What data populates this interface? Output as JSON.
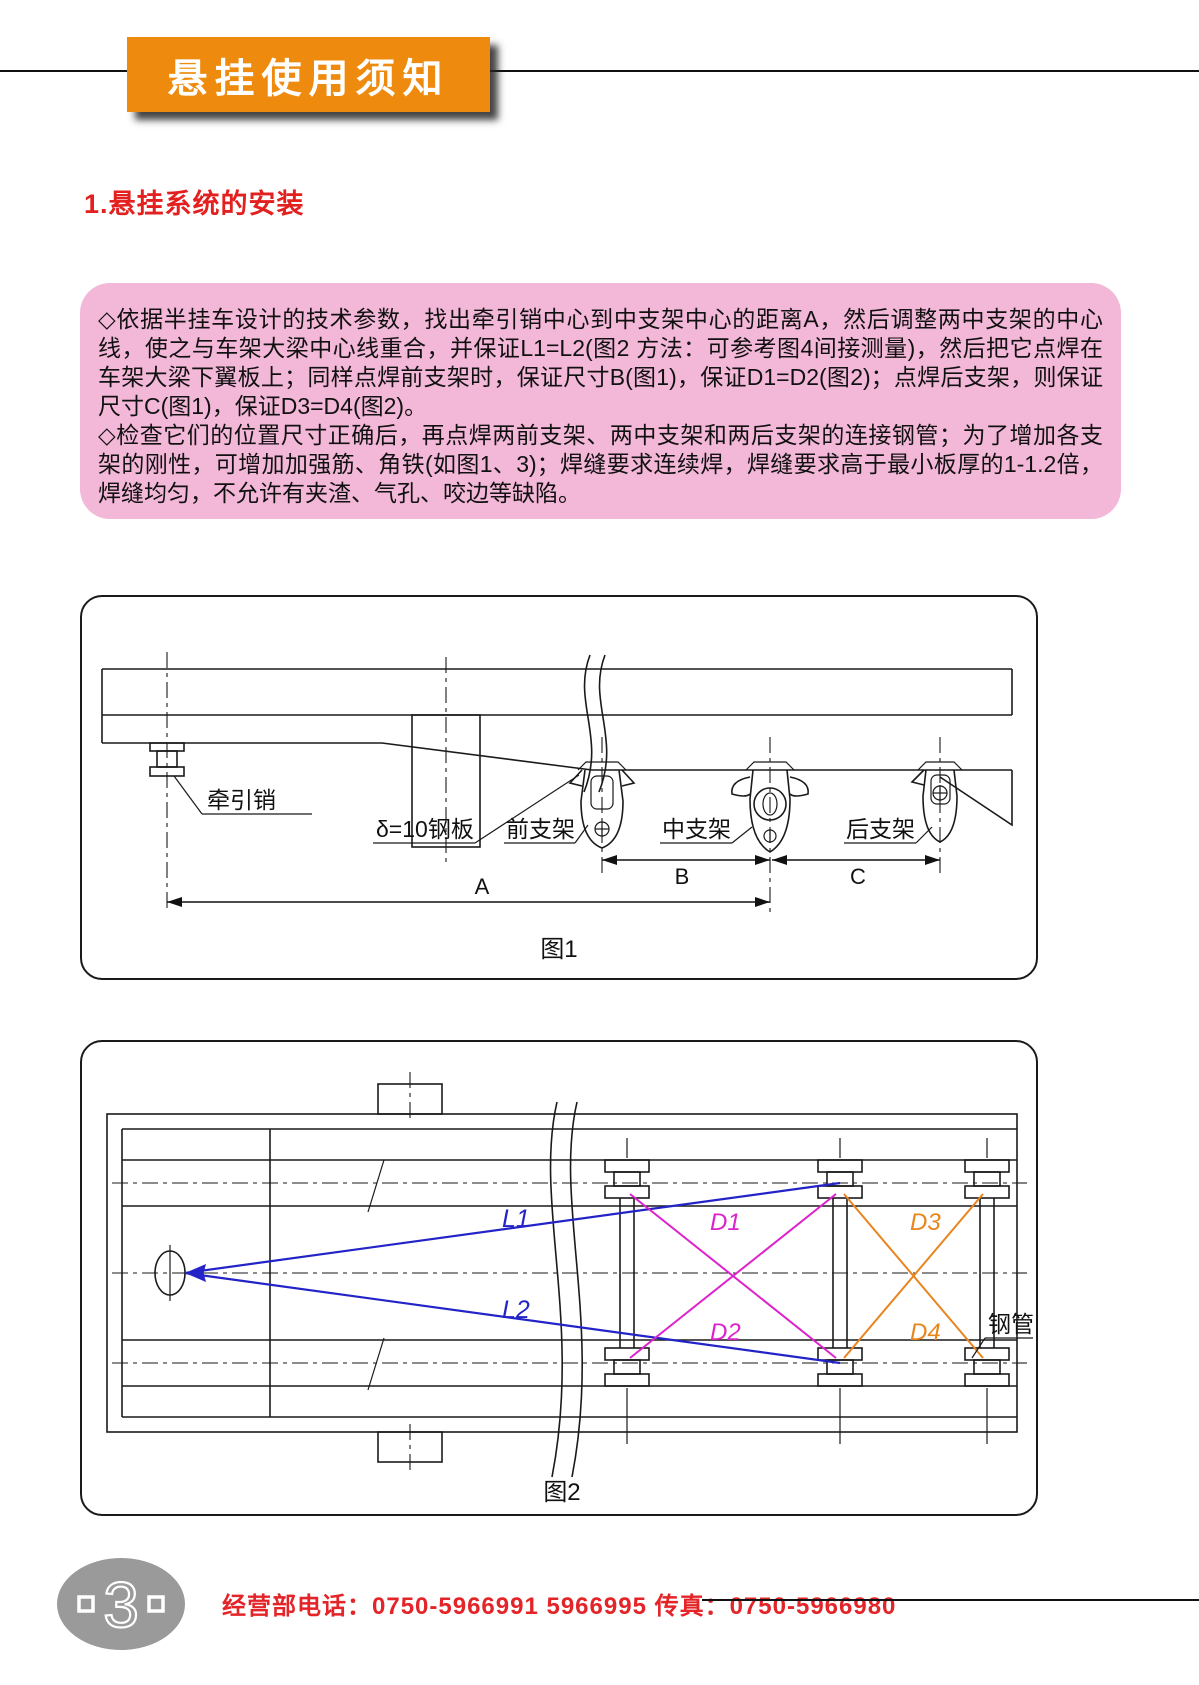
{
  "header": {
    "title": "悬挂使用须知"
  },
  "section": {
    "heading": "1.悬挂系统的安装"
  },
  "notice": {
    "paragraphs": [
      "◇依据半挂车设计的技术参数，找出牵引销中心到中支架中心的距离A，然后调整两中支架的中心线，使之与车架大梁中心线重合，并保证L1=L2(图2 方法：可参考图4间接测量)，然后把它点焊在车架大梁下翼板上；同样点焊前支架时，保证尺寸B(图1)，保证D1=D2(图2)；点焊后支架，则保证尺寸C(图1)，保证D3=D4(图2)。",
      "◇检查它们的位置尺寸正确后，再点焊两前支架、两中支架和两后支架的连接钢管；为了增加各支架的刚性，可增加加强筋、角铁(如图1、3)；焊缝要求连续焊，焊缝要求高于最小板厚的1-1.2倍，焊缝均匀，不允许有夹渣、气孔、咬边等缺陷。"
    ]
  },
  "figure1": {
    "caption": "图1",
    "labels": {
      "kingpin": "牵引销",
      "plate": "δ=10钢板",
      "front_bracket": "前支架",
      "middle_bracket": "中支架",
      "rear_bracket": "后支架"
    },
    "dimensions": {
      "a": "A",
      "b": "B",
      "c": "C"
    }
  },
  "figure2": {
    "caption": "图2",
    "labels": {
      "l1": "L1",
      "l2": "L2",
      "d1": "D1",
      "d2": "D2",
      "d3": "D3",
      "d4": "D4",
      "pipe": "钢管"
    }
  },
  "footer": {
    "page_number": "3",
    "contact": "经营部电话：0750-5966991 5966995 传真：0750-5966980"
  },
  "colors": {
    "banner_orange": "#ee8b0e",
    "heading_red": "#e32020",
    "notice_pink": "#f3b7d8",
    "line_l_blue": "#2323c8",
    "line_d12_magenta": "#dd22cc",
    "line_d34_orange": "#e8851e",
    "badge_gray": "#9a9a9a",
    "footer_red": "#e32428"
  }
}
